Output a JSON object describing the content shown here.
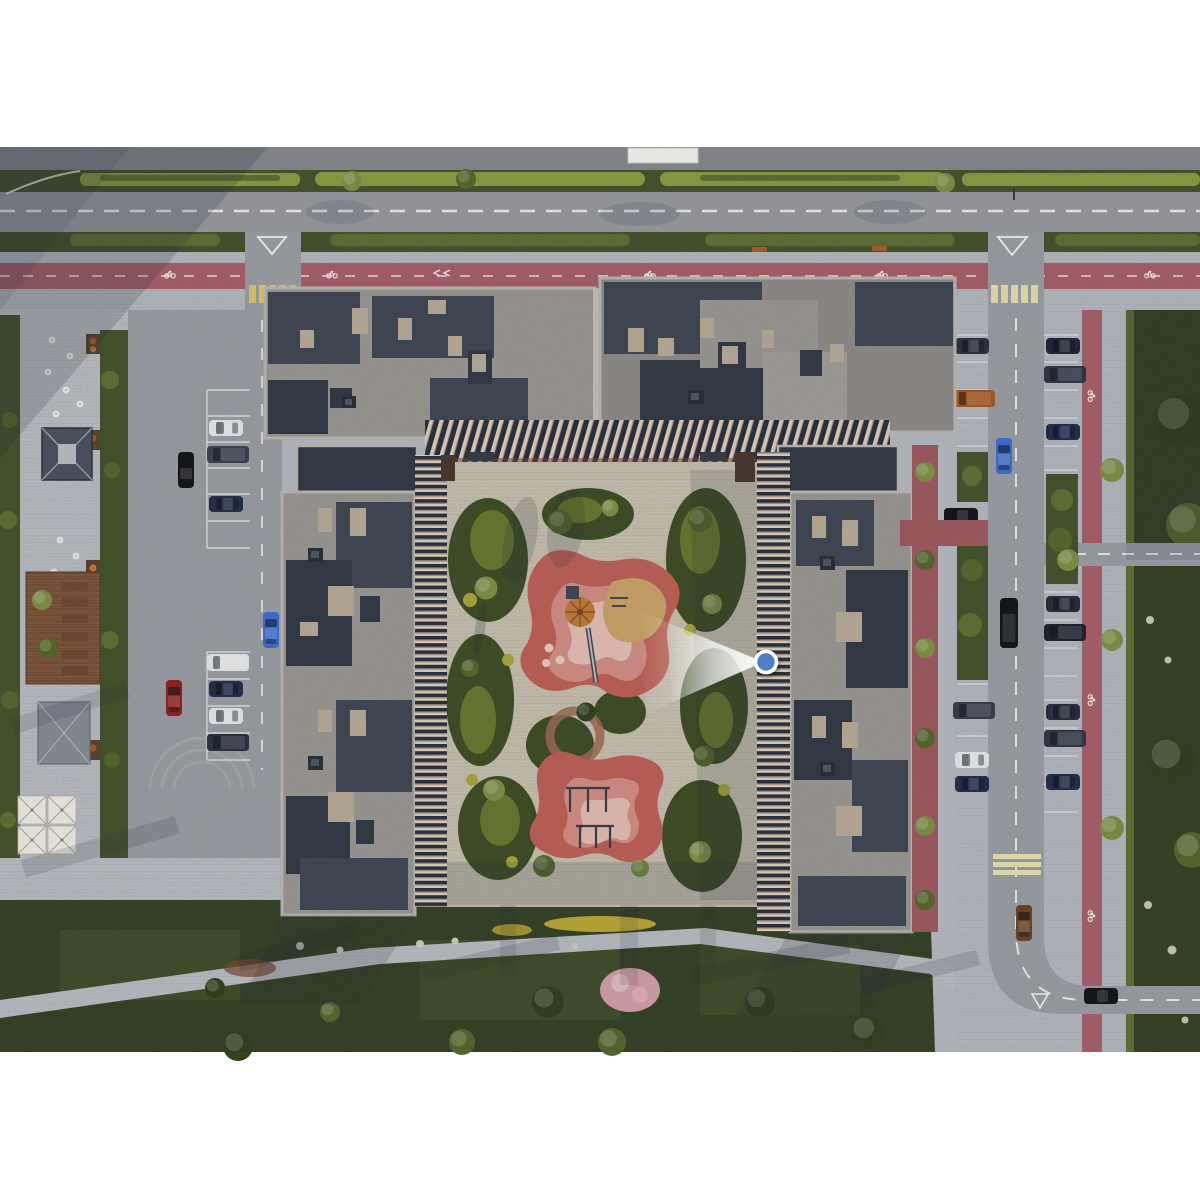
{
  "canvas": {
    "width": 1200,
    "height": 1200,
    "content_top": 147,
    "content_bottom": 1052
  },
  "scene": {
    "type": "aerial-architectural-render",
    "areas": [
      "main-road-top",
      "red-bike-lane-top",
      "left-plaza-cafe",
      "left-parking-lot",
      "u-shaped-residential-complex",
      "courtyard-playground",
      "east-street-parking",
      "east-bike-lane",
      "east-lawn",
      "south-lawn"
    ]
  },
  "marker": {
    "name": "viewpoint-marker",
    "x": 766,
    "y": 662,
    "transform": "translate(766,662)",
    "dot_color": "#4d7ec8",
    "ring_color": "#ffffff",
    "cone_direction": "left"
  },
  "palette": {
    "bg": "#ffffff",
    "road_upper": "#86888e",
    "road": "#97999f",
    "road_side": "#9a9da3",
    "road_line": "#f2f2f2",
    "sidewalk": "#b4b8bf",
    "plaza": "#b9bcc2",
    "court_pave": "#c6bfae",
    "bike_red": "#a7616b",
    "promenade_red": "#9e5a60",
    "zebra_yellow": "#ddc468",
    "verge_green": "#46542f",
    "hedge_bright": "#8a9c44",
    "hedge_mid": "#5f7135",
    "lawn": "#374428",
    "lawn_light": "#49592f",
    "mound_dark": "#3f4f28",
    "mound_mid": "#697832",
    "mound_yellow": "#a8a63e",
    "tree": "#56682f",
    "tree_light": "#7e9048",
    "tree_dark": "#33421f",
    "roof_light": "#9a9793",
    "roof_mid": "#8e8b89",
    "roof_navy": "#414855",
    "roof_navy2": "#343b48",
    "parapet": "#bab6b0",
    "box_beige": "#b7aa97",
    "brick": "#7e4238",
    "facade_cream": "#d9cfbe",
    "facade_dark": "#2c323e",
    "deck_brown": "#80583c",
    "furniture_brown": "#6e4a30",
    "white_struct": "#f2f1ee",
    "car_navy": "#252f4d",
    "car_black": "#17181c",
    "car_white": "#e4e6e9",
    "car_red": "#8e2420",
    "car_blue": "#3f6fd0",
    "car_brown": "#6e4526",
    "car_orange": "#a55a22",
    "shadow": "#232a3a"
  }
}
